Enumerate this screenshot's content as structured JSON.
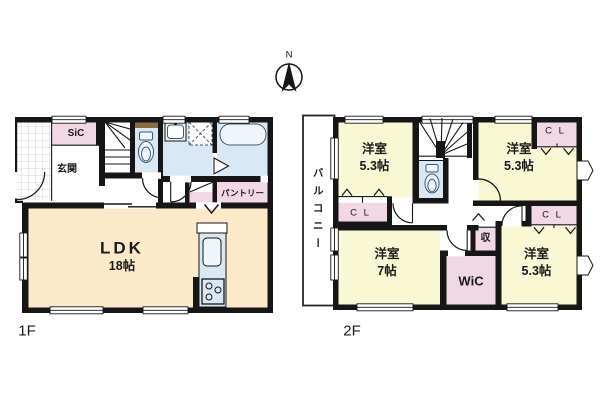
{
  "compass": {
    "north_label": "N"
  },
  "floor_1f": {
    "floor_label": "1F",
    "rooms": {
      "shoe_closet": "SiC",
      "entrance": "玄関",
      "pantry": "パントリー",
      "ldk_name": "LDK",
      "ldk_size": "18帖"
    }
  },
  "floor_2f": {
    "floor_label": "2F",
    "rooms": {
      "balcony": "バルコニー",
      "bedroom_nw_name": "洋室",
      "bedroom_nw_size": "5.3帖",
      "bedroom_ne_name": "洋室",
      "bedroom_ne_size": "5.3帖",
      "bedroom_sw_name": "洋室",
      "bedroom_sw_size": "7帖",
      "bedroom_se_name": "洋室",
      "bedroom_se_size": "5.3帖",
      "closet_nw": "C L",
      "closet_ne": "C L",
      "closet_se": "C L",
      "walk_in_closet": "WiC",
      "storage": "収"
    }
  },
  "colors": {
    "wall": "#161616",
    "closet_pink": "#f1d8e4",
    "bedroom_yellow": "#f8f8d5",
    "wet_area_blue": "#d8e9f5",
    "ldk_cream": "#fce9c9",
    "fixture_blue": "#eef6fc",
    "counter_brown": "#8a6b41"
  }
}
